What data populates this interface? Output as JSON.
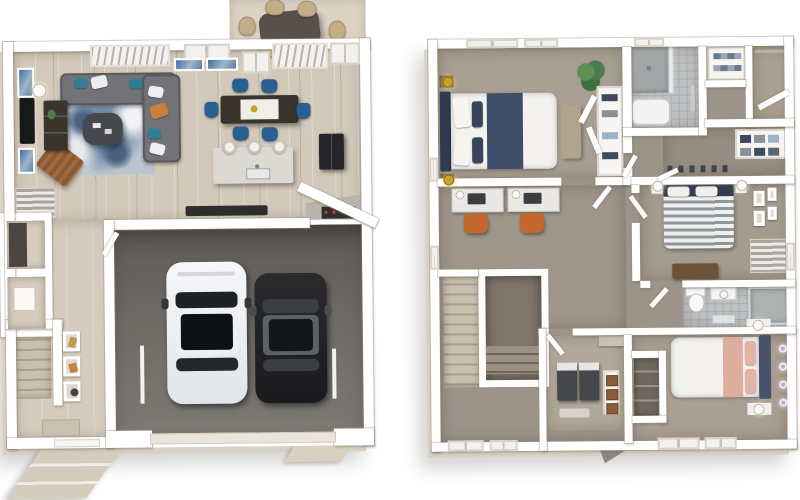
{
  "image": {
    "type": "3d-floor-plan-rendering",
    "style": "top-down dollhouse view, two plans side by side",
    "background": "#ffffff",
    "floor_count": 2
  },
  "colors": {
    "wall": "#ffffff",
    "wallShade": "#d7d0c4",
    "wood": "#d2c9ba",
    "entry": "#d6ccbd",
    "garage": "#6e6a66",
    "garageDark": "#5d5956",
    "carpetBed1": "#a89f93",
    "carpetOffice": "#9e968a",
    "carpetHall": "#9c9489",
    "tile": "#bdc0c1",
    "tileLine": "#aaadad",
    "patio": "#ddd3c3",
    "wicker": "#c2ad87",
    "patioTable": "#575149",
    "rugBase": "#b9c4cf",
    "rugBlue": "#6d87a4",
    "rugDark": "#47617f",
    "sofa": "#737377",
    "cushionTeal": "#2e7f93",
    "cushionOrange": "#c9803d",
    "white": "#f2f1ee",
    "tableDark": "#38332b",
    "chairBlue": "#2a5f93",
    "island": "#dcd9d3",
    "fridge": "#26262a",
    "stoveRed": "#c23b2e",
    "carWhite": "#f2f3f5",
    "carBlack": "#212124",
    "glassDark": "#1e2125",
    "roofGray": "#5d6166",
    "navy": "#3e4d68",
    "navyDark": "#2f3a50",
    "bedWhite": "#f3f2ef",
    "bench": "#b2a38f",
    "gold": "#c9a227",
    "plant": "#4c7c4e",
    "desk": "#eae8e4",
    "orange": "#c4682f",
    "stripeGray": "#8f979e",
    "blush": "#dcae9e",
    "headboard3": "#47536a",
    "lilac": "#bfa8cc",
    "laundry": "#45474a",
    "basket": "#8a5c39",
    "brown": "#6e5238",
    "consoleBrown": "#3a342c",
    "stairTread": "#cabfae",
    "stairGap": "#a99f90",
    "matDark": "#2c2d2f",
    "shelfWood": "#6e675e"
  },
  "floor1": {
    "name": "first-floor",
    "position": "left",
    "rooms": [
      {
        "name": "patio",
        "furniture": [
          "outdoor-dining-table",
          "wicker-chair x6"
        ]
      },
      {
        "name": "living-room",
        "floor": "light-wood",
        "furniture": [
          "gray-sectional-sofa",
          "blue-mottled-area-rug",
          "round-coffee-table",
          "wall-tv",
          "media-console",
          "brown-lounge-chair",
          "floor-lamp",
          "blue-wall-art x3",
          "windows-with-blinds"
        ]
      },
      {
        "name": "dining-area",
        "floor": "light-wood",
        "furniture": [
          "dark-dining-table-with-white-runner",
          "blue-chair x6"
        ]
      },
      {
        "name": "kitchen",
        "floor": "light-wood",
        "furniture": [
          "kitchen-island-with-sink",
          "white-stool x3",
          "refrigerator",
          "corner-range-with-red-knobs",
          "dark-floor-mat"
        ]
      },
      {
        "name": "entry-hall",
        "floor": "beige",
        "furniture": [
          "slatted-bench",
          "gallery-frame x3",
          "door-mat",
          "closet x2"
        ]
      },
      {
        "name": "staircase",
        "details": "straight run along left wall"
      },
      {
        "name": "two-car-garage",
        "floor": "dark-gray-concrete",
        "furniture": [
          "white-car",
          "black-car",
          "garage-door"
        ]
      },
      {
        "name": "front-entry",
        "furniture": [
          "front-door",
          "exterior-walkway-steps",
          "driveway-apron"
        ]
      }
    ]
  },
  "floor2": {
    "name": "second-floor",
    "position": "right",
    "rooms": [
      {
        "name": "primary-bedroom",
        "floor": "taupe-carpet",
        "furniture": [
          "bed-navy-and-white",
          "navy-headboard",
          "tufted-bench",
          "nightstand-with-gold-lamp x2",
          "potted-plant",
          "open-wardrobe-shelving",
          "windows"
        ]
      },
      {
        "name": "office-loft",
        "floor": "taupe-carpet",
        "furniture": [
          "white-desk x2",
          "laptop x2",
          "orange-task-chair x2",
          "desk-lamp x2"
        ]
      },
      {
        "name": "bathroom-1",
        "floor": "gray-tile",
        "furniture": [
          "walk-in-shower",
          "glass-panel",
          "bathtub",
          "towel-bar"
        ]
      },
      {
        "name": "linen-closet",
        "furniture": [
          "shelves-with-folded-towels"
        ]
      },
      {
        "name": "closet-with-rod",
        "furniture": [
          "hanging-rod",
          "open-door"
        ]
      },
      {
        "name": "walk-in-closet",
        "furniture": [
          "clothes-shelves",
          "folded-clothes-stacks",
          "shoe-row"
        ]
      },
      {
        "name": "bedroom-2",
        "floor": "taupe-carpet",
        "furniture": [
          "bed-gray-striped",
          "navy-pillows",
          "nightstand-with-lamp x2",
          "wall-art x4",
          "slatted-window-unit",
          "dresser"
        ]
      },
      {
        "name": "bathroom-2",
        "floor": "gray-tile",
        "furniture": [
          "toilet",
          "vanity-sink",
          "glass-shower",
          "bath-mat"
        ]
      },
      {
        "name": "bedroom-3",
        "floor": "taupe-carpet",
        "furniture": [
          "bed-white-with-blush-runner",
          "navy-headboard",
          "nightstand-with-lamp x2",
          "lilac-wall-sconce x4",
          "bottom-wall-windows",
          "shoe-closet"
        ]
      },
      {
        "name": "laundry-room",
        "furniture": [
          "washer",
          "dryer",
          "basket-shelf-with-3-baskets",
          "upper-shelf",
          "small-rug"
        ]
      },
      {
        "name": "staircase-and-open-stairwell",
        "furniture": [
          "white-railing"
        ]
      }
    ]
  }
}
